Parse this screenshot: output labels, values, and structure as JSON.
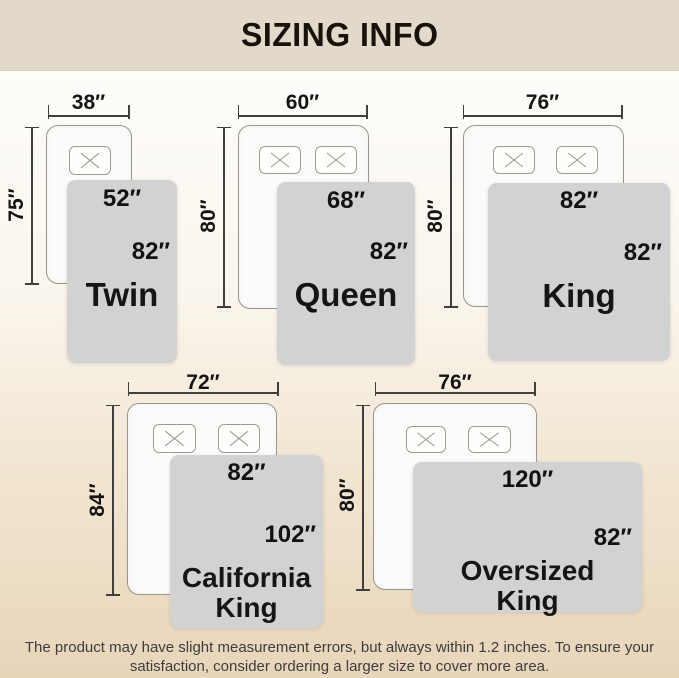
{
  "header": {
    "title": "SIZING INFO"
  },
  "beds": [
    {
      "name": "Twin",
      "display_name": "Twin",
      "mattress_width": "38″",
      "mattress_length": "75″",
      "blanket_width": "52″",
      "blanket_length": "82″",
      "pillows": 1
    },
    {
      "name": "Queen",
      "display_name": "Queen",
      "mattress_width": "60″",
      "mattress_length": "80″",
      "blanket_width": "68″",
      "blanket_length": "82″",
      "pillows": 2
    },
    {
      "name": "King",
      "display_name": "King",
      "mattress_width": "76″",
      "mattress_length": "80″",
      "blanket_width": "82″",
      "blanket_length": "82″",
      "pillows": 2
    },
    {
      "name": "California King",
      "display_name": "California\nKing",
      "mattress_width": "72″",
      "mattress_length": "84″",
      "blanket_width": "82″",
      "blanket_length": "102″",
      "pillows": 2
    },
    {
      "name": "Oversized King",
      "display_name": "Oversized\nKing",
      "mattress_width": "76″",
      "mattress_length": "80″",
      "blanket_width": "120″",
      "blanket_length": "82″",
      "pillows": 2
    }
  ],
  "footer": {
    "line1": "The product may have slight measurement errors, but always within 1.2 inches. To ensure your",
    "line2": "satisfaction, consider ordering a larger size to cover more area."
  },
  "colors": {
    "header_bg": "#e2d9ca",
    "page_top": "#fefdfb",
    "page_bottom": "#e8d5ba",
    "blanket": "#d2d2d2",
    "mattress": "#fbfbf9",
    "dimension_line": "#3f3f3f",
    "text": "#141414"
  }
}
